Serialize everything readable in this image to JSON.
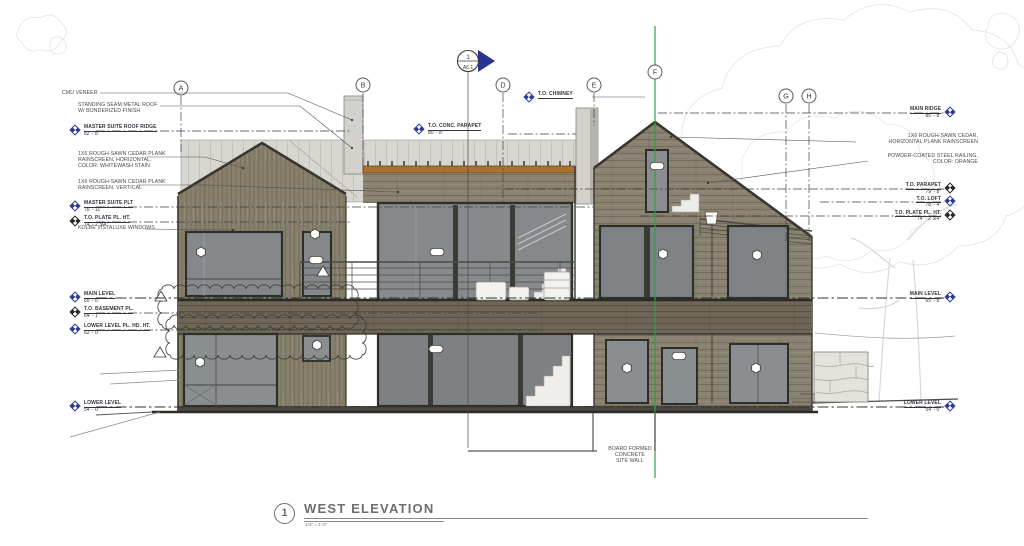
{
  "sheet": {
    "title": "WEST ELEVATION",
    "scale": "1/4\" = 1'-0\"",
    "detail_number": "1"
  },
  "section_marker": {
    "number": "1",
    "sheet": "A6.1"
  },
  "grids": [
    "A",
    "B",
    "D",
    "E",
    "F",
    "G",
    "H"
  ],
  "levels": {
    "left": [
      {
        "name": "MASTER SUITE ROOF RIDGE",
        "elev": "82' - 8\""
      },
      {
        "name": "MASTER SUITE PLT",
        "elev": "76' - 11\""
      },
      {
        "name": "T.O. PLATE PL. HT.",
        "elev": "74' - 2 3/4\""
      },
      {
        "name": "MAIN LEVEL",
        "elev": "65' - 6\""
      },
      {
        "name": "T.O. BASEMENT PL.",
        "elev": "64' - 1\""
      },
      {
        "name": "LOWER LEVEL PL. HD. HT.",
        "elev": "62' - 0\""
      },
      {
        "name": "LOWER LEVEL",
        "elev": "54' - 0\""
      }
    ],
    "right": [
      {
        "name": "MAIN RIDGE",
        "elev": "85' - 8\""
      },
      {
        "name": "T.O. PARAPET",
        "elev": "79' - 8\""
      },
      {
        "name": "T.O. LOFT",
        "elev": "78' - 4\""
      },
      {
        "name": "T.O. PLATE PL. HT.",
        "elev": "74' - 2 3/4\""
      },
      {
        "name": "MAIN LEVEL",
        "elev": "65' - 6\""
      },
      {
        "name": "LOWER LEVEL",
        "elev": "54' - 0\""
      }
    ],
    "top": [
      {
        "name": "T.O. CHIMNEY",
        "elev": ""
      },
      {
        "name": "T.O. CONC. PARAPET",
        "elev": "80' - 8\""
      }
    ]
  },
  "notes": {
    "cmu": "CMU VENEER",
    "metal_roof": [
      "STANDING SEAM METAL ROOF",
      "W/ BONDERIZED FINISH"
    ],
    "cedar_horiz": [
      "1X6 ROUGH-SAWN CEDAR PLANK",
      "RAINSCREEN, HORIZONTAL,",
      "COLOR: WHITEWASH STAIN"
    ],
    "cedar_vert": [
      "1X6 ROUGH-SAWN CEDAR PLANK",
      "RAINSCREEN, VERTICAL"
    ],
    "windows": "KOLBE VISTALUXE WINDOWS",
    "cedar_right": [
      "1X6 ROUGH-SAWN CEDAR,",
      "HORIZONTAL PLANK RAINSCREEN"
    ],
    "railing": [
      "POWDER-COATED STEEL RAILING,",
      "COLOR: ORANGE"
    ],
    "site_wall": [
      "BOARD FORMED CONCRETE",
      "SITE WALL"
    ]
  },
  "colors": {
    "marker_blue": "#283593",
    "grid_green": "#2f9e44",
    "deck_orange": "#a9732f",
    "wood": "#857c69",
    "glass": "#85888a",
    "metal_wall": "#d8d6d1"
  }
}
